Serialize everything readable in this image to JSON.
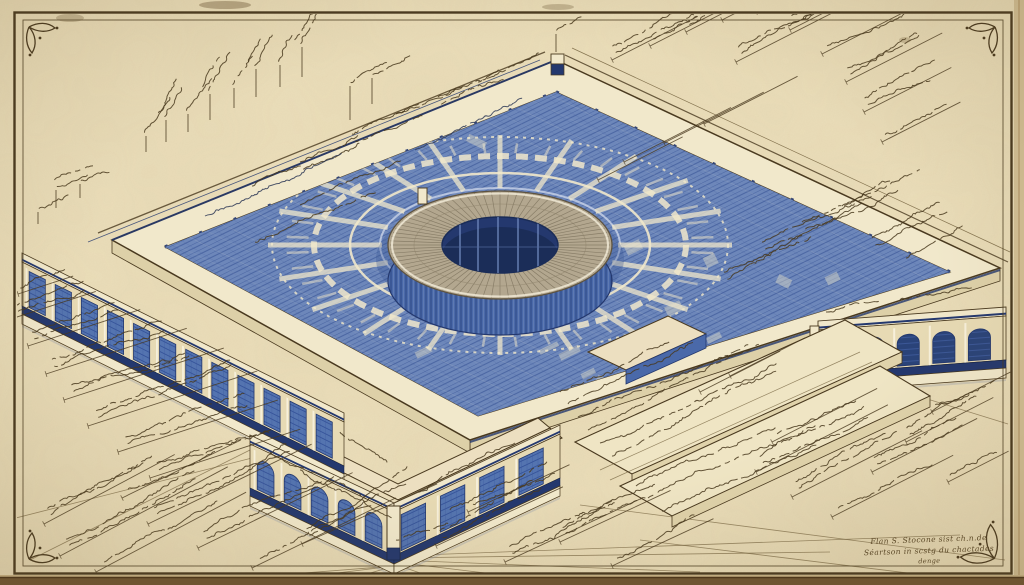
{
  "scene": {
    "description": "Vintage hand-drawn architectural blueprint: isometric view of a square monumental building with a central circular rotunda and oculus, blue-washed plaza with radial paving, arcaded colonnade wings, stepped terraces, surrounded by illegible handwritten annotations on aged paper with a ruled sepia frame and corner flourishes",
    "title_block": {
      "lines": [
        "Flan S. Stocone sist ch.n.de",
        "Séartson in scstg du chactades",
        "denge"
      ]
    }
  },
  "palette": {
    "paper": "#ecdfbb",
    "paper_shade": "#ddcda2",
    "edge_dark": "#6f5532",
    "ink": "#49391f",
    "ink_soft": "#6e5c38",
    "ink_blue": "#2f3a57",
    "blue_field": "#6d87ba",
    "blue_hatch": "#46619f",
    "blue_wall": "#4a69a9",
    "blue_dark": "#2c4784",
    "navy": "#24386e",
    "cream": "#f1e8cb",
    "cream_dim": "#e7dab4",
    "tan_ring": "#b3a78f",
    "ring_hatch": "#665c48",
    "shade": "#ddd0a8"
  },
  "figure": {
    "left_windows": 12,
    "pavilion_arches": 5,
    "pavilion_panels": 4,
    "right_arches": 5,
    "ring_spokes": 20
  },
  "annotations": [
    [
      146,
      152,
      -58,
      16,
      1,
      1,
      0
    ],
    [
      166,
      142,
      -58,
      22,
      2,
      1,
      0
    ],
    [
      188,
      132,
      -58,
      18,
      1,
      1,
      0
    ],
    [
      210,
      120,
      -58,
      26,
      2,
      1,
      0
    ],
    [
      234,
      108,
      -58,
      20,
      1,
      1,
      0
    ],
    [
      256,
      97,
      -58,
      28,
      2,
      1,
      0
    ],
    [
      280,
      87,
      -58,
      22,
      1,
      1,
      0
    ],
    [
      302,
      77,
      -58,
      30,
      2,
      1,
      0
    ],
    [
      300,
      162,
      -24,
      64,
      2,
      2,
      0
    ],
    [
      352,
      134,
      -24,
      72,
      2,
      2,
      0
    ],
    [
      396,
      114,
      -24,
      78,
      1,
      2,
      0
    ],
    [
      438,
      97,
      -24,
      66,
      2,
      2,
      0
    ],
    [
      478,
      82,
      -24,
      70,
      1,
      2,
      0
    ],
    [
      252,
      186,
      -24,
      58,
      1,
      2,
      0
    ],
    [
      205,
      216,
      -24,
      170,
      1,
      2,
      1
    ],
    [
      255,
      242,
      -24,
      150,
      1,
      2,
      0
    ],
    [
      415,
      150,
      -24,
      130,
      1,
      2,
      1
    ],
    [
      300,
      205,
      -24,
      120,
      1,
      2,
      0
    ],
    [
      350,
      120,
      -24,
      34,
      1,
      1,
      0
    ],
    [
      372,
      104,
      -24,
      26,
      1,
      1,
      0
    ],
    [
      556,
      52,
      -26,
      18,
      1,
      1,
      0
    ],
    [
      612,
      60,
      -27,
      96,
      2,
      0,
      0
    ],
    [
      650,
      46,
      -27,
      86,
      1,
      0,
      0
    ],
    [
      686,
      32,
      -27,
      92,
      2,
      0,
      0
    ],
    [
      722,
      20,
      -27,
      80,
      1,
      0,
      0
    ],
    [
      756,
      12,
      -27,
      72,
      2,
      0,
      0
    ],
    [
      790,
      30,
      -27,
      112,
      2,
      0,
      0
    ],
    [
      822,
      54,
      -27,
      118,
      1,
      0,
      0
    ],
    [
      846,
      82,
      -27,
      108,
      2,
      0,
      0
    ],
    [
      864,
      112,
      -27,
      98,
      2,
      0,
      0
    ],
    [
      882,
      142,
      -27,
      88,
      1,
      0,
      0
    ],
    [
      794,
      8,
      -27,
      58,
      1,
      0,
      0
    ],
    [
      736,
      62,
      -27,
      126,
      2,
      0,
      0
    ],
    [
      624,
      162,
      -27,
      120,
      0,
      3,
      0
    ],
    [
      664,
      143,
      -27,
      112,
      0,
      3,
      0
    ],
    [
      704,
      124,
      -27,
      105,
      0,
      3,
      0
    ],
    [
      598,
      180,
      -27,
      95,
      0,
      3,
      0
    ],
    [
      762,
      242,
      -25,
      118,
      2,
      2,
      0
    ],
    [
      802,
      222,
      -25,
      108,
      2,
      2,
      0
    ],
    [
      842,
      206,
      -25,
      88,
      1,
      2,
      0
    ],
    [
      724,
      272,
      -25,
      98,
      2,
      2,
      0
    ],
    [
      872,
      238,
      -25,
      78,
      2,
      2,
      0
    ],
    [
      906,
      258,
      -25,
      68,
      1,
      2,
      0
    ],
    [
      56,
      208,
      -20,
      18,
      2,
      1,
      0
    ],
    [
      80,
      198,
      -20,
      14,
      1,
      1,
      0
    ],
    [
      38,
      224,
      -20,
      12,
      1,
      1,
      0
    ],
    [
      14,
      318,
      -18,
      86,
      2,
      0,
      0
    ],
    [
      28,
      346,
      -18,
      118,
      2,
      0,
      0
    ],
    [
      46,
      374,
      -18,
      148,
      2,
      0,
      0
    ],
    [
      64,
      400,
      -18,
      168,
      2,
      0,
      0
    ],
    [
      88,
      426,
      -18,
      178,
      2,
      0,
      0
    ],
    [
      118,
      452,
      -18,
      168,
      2,
      0,
      0
    ],
    [
      18,
      294,
      -18,
      58,
      1,
      0,
      0
    ],
    [
      150,
      478,
      -18,
      158,
      2,
      0,
      0
    ],
    [
      60,
      556,
      -28,
      190,
      2,
      0,
      0
    ],
    [
      96,
      572,
      -28,
      170,
      1,
      0,
      0
    ],
    [
      44,
      524,
      -28,
      148,
      2,
      0,
      0
    ],
    [
      148,
      524,
      -26,
      182,
      2,
      0,
      0
    ],
    [
      198,
      548,
      -26,
      172,
      2,
      0,
      0
    ],
    [
      252,
      568,
      -26,
      160,
      1,
      0,
      0
    ],
    [
      122,
      498,
      -26,
      132,
      1,
      0,
      0
    ],
    [
      302,
      544,
      -24,
      148,
      2,
      0,
      0
    ],
    [
      436,
      546,
      -25,
      140,
      2,
      0,
      0
    ],
    [
      505,
      562,
      -25,
      150,
      2,
      0,
      0
    ],
    [
      468,
      512,
      -25,
      112,
      1,
      0,
      0
    ],
    [
      560,
      542,
      -25,
      122,
      2,
      0,
      0
    ],
    [
      612,
      566,
      -25,
      112,
      1,
      0,
      0
    ],
    [
      270,
      452,
      26,
      120,
      1,
      2,
      0
    ],
    [
      300,
      470,
      26,
      110,
      1,
      2,
      0
    ],
    [
      418,
      492,
      -26,
      120,
      1,
      2,
      0
    ],
    [
      450,
      510,
      -26,
      118,
      1,
      2,
      0
    ],
    [
      588,
      430,
      -25,
      200,
      1,
      2,
      0
    ],
    [
      600,
      443,
      -25,
      205,
      1,
      2,
      0
    ],
    [
      612,
      456,
      -25,
      200,
      1,
      2,
      0
    ],
    [
      578,
      417,
      -25,
      185,
      1,
      2,
      0
    ],
    [
      568,
      404,
      -25,
      160,
      1,
      2,
      0
    ],
    [
      560,
      392,
      -25,
      130,
      1,
      2,
      0
    ],
    [
      648,
      498,
      -25,
      195,
      1,
      2,
      0
    ],
    [
      662,
      511,
      -25,
      185,
      1,
      2,
      0
    ],
    [
      636,
      486,
      -25,
      165,
      1,
      2,
      0
    ],
    [
      756,
      472,
      -27,
      148,
      2,
      0,
      0
    ],
    [
      792,
      497,
      -27,
      146,
      2,
      0,
      0
    ],
    [
      832,
      517,
      -27,
      136,
      1,
      0,
      0
    ],
    [
      772,
      442,
      -27,
      118,
      1,
      0,
      0
    ],
    [
      872,
      472,
      -27,
      118,
      2,
      0,
      0
    ],
    [
      906,
      442,
      -27,
      98,
      2,
      0,
      0
    ],
    [
      932,
      412,
      -27,
      88,
      1,
      0,
      0
    ],
    [
      948,
      482,
      -27,
      68,
      1,
      0,
      0
    ],
    [
      700,
      392,
      -27,
      90,
      0,
      3,
      0
    ],
    [
      730,
      376,
      -27,
      84,
      0,
      3,
      0
    ],
    [
      396,
      540,
      -20,
      60,
      1,
      2,
      0
    ],
    [
      340,
      432,
      26,
      60,
      1,
      2,
      0
    ],
    [
      826,
      312,
      -10,
      60,
      1,
      2,
      0
    ],
    [
      900,
      300,
      -12,
      70,
      1,
      2,
      0
    ]
  ]
}
